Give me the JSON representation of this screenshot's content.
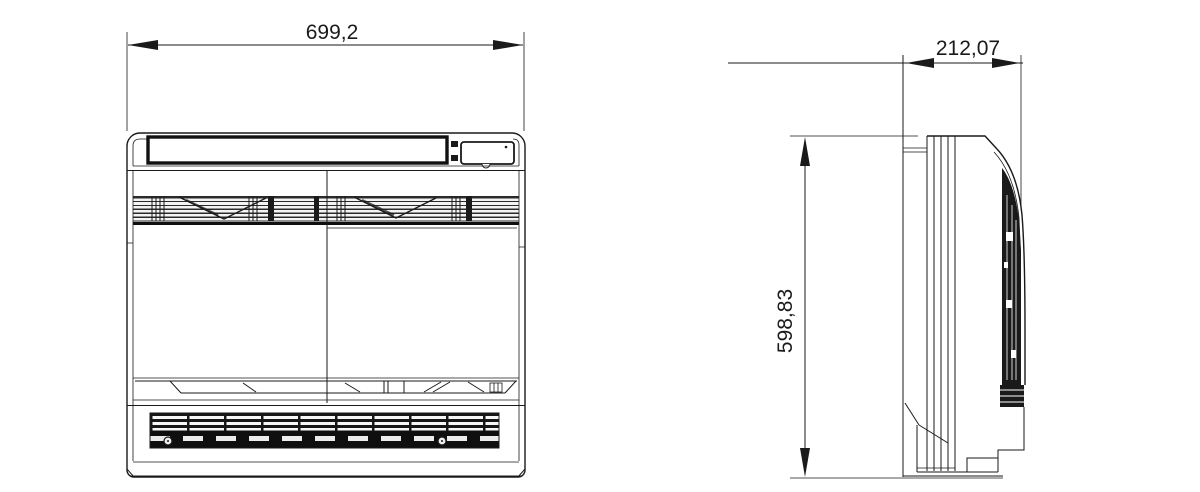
{
  "page": {
    "background_color": "#ffffff",
    "line_color": "#1a1a1a"
  },
  "drawing": {
    "kind": "technical dimensional drawing, front view and side view of floor-standing unit",
    "views": [
      {
        "id": "front-view",
        "dimension_labels": [
          "699,2"
        ]
      },
      {
        "id": "side-view",
        "dimension_labels": [
          "212,07",
          "598,83"
        ]
      }
    ]
  },
  "dimensions": {
    "front_width": "699,2",
    "side_depth": "212,07",
    "side_height": "598,83"
  }
}
